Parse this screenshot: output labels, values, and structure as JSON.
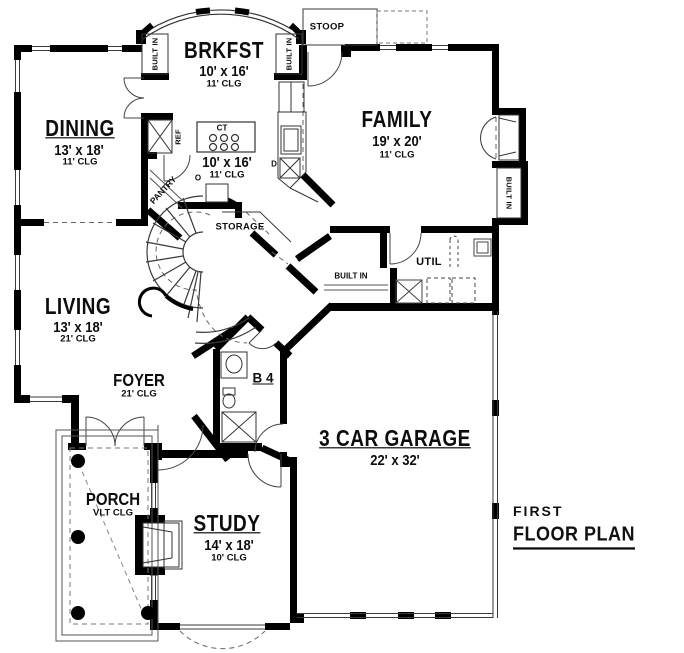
{
  "title": {
    "line1": "FIRST",
    "line2": "FLOOR PLAN"
  },
  "rooms": {
    "brkfst": {
      "name": "BRKFST",
      "dims": "10' x 16'",
      "clg": "11' CLG"
    },
    "dining": {
      "name": "DINING",
      "dims": "13' x 18'",
      "clg": "11' CLG"
    },
    "family": {
      "name": "FAMILY",
      "dims": "19' x 20'",
      "clg": "11' CLG"
    },
    "kitchen": {
      "dims": "10' x 16'",
      "clg": "11' CLG"
    },
    "living": {
      "name": "LIVING",
      "dims": "13' x 18'",
      "clg": "21' CLG"
    },
    "foyer": {
      "name": "FOYER",
      "clg": "21' CLG"
    },
    "porch": {
      "name": "PORCH",
      "clg": "VLT CLG"
    },
    "study": {
      "name": "STUDY",
      "dims": "14' x 18'",
      "clg": "10' CLG"
    },
    "garage": {
      "name": "3 CAR GARAGE",
      "dims": "22' x 32'"
    },
    "util": {
      "name": "UTIL"
    },
    "bath": {
      "name": "B 4"
    },
    "storage": {
      "name": "STORAGE"
    },
    "pantry": {
      "name": "PANTRY"
    },
    "stoop": {
      "name": "STOOP"
    }
  },
  "annotations": {
    "built_in": "BUILT IN",
    "ref": "REF",
    "cooktop": "CT",
    "dishwasher": "D",
    "oven": "O"
  },
  "colors": {
    "ink": "#000000",
    "thin_line": "#3a3a3a",
    "dash_line": "#666666",
    "background": "#ffffff"
  }
}
